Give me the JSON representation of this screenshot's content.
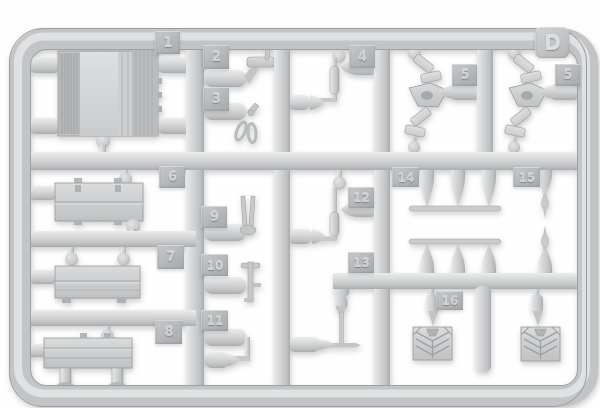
{
  "sprue": {
    "plate_letter": "D",
    "tags": [
      {
        "id": "part-1",
        "label": "1"
      },
      {
        "id": "part-2",
        "label": "2"
      },
      {
        "id": "part-3",
        "label": "3"
      },
      {
        "id": "part-4",
        "label": "4"
      },
      {
        "id": "part-5a",
        "label": "5"
      },
      {
        "id": "part-5b",
        "label": "5"
      },
      {
        "id": "part-6",
        "label": "6"
      },
      {
        "id": "part-7",
        "label": "7"
      },
      {
        "id": "part-8",
        "label": "8"
      },
      {
        "id": "part-9",
        "label": "9"
      },
      {
        "id": "part-10",
        "label": "10"
      },
      {
        "id": "part-11",
        "label": "11"
      },
      {
        "id": "part-12",
        "label": "12"
      },
      {
        "id": "part-13",
        "label": "13"
      },
      {
        "id": "part-14",
        "label": "14"
      },
      {
        "id": "part-15",
        "label": "15"
      },
      {
        "id": "part-16",
        "label": "16"
      }
    ]
  },
  "colors": {
    "background": "#fefefe",
    "plastic_light": "#ebecec",
    "plastic_mid": "#c7c9cb",
    "plastic_dark": "#a8abad",
    "tag_face": "#b2b5b7",
    "tag_numeral": "#d0d3d5"
  }
}
